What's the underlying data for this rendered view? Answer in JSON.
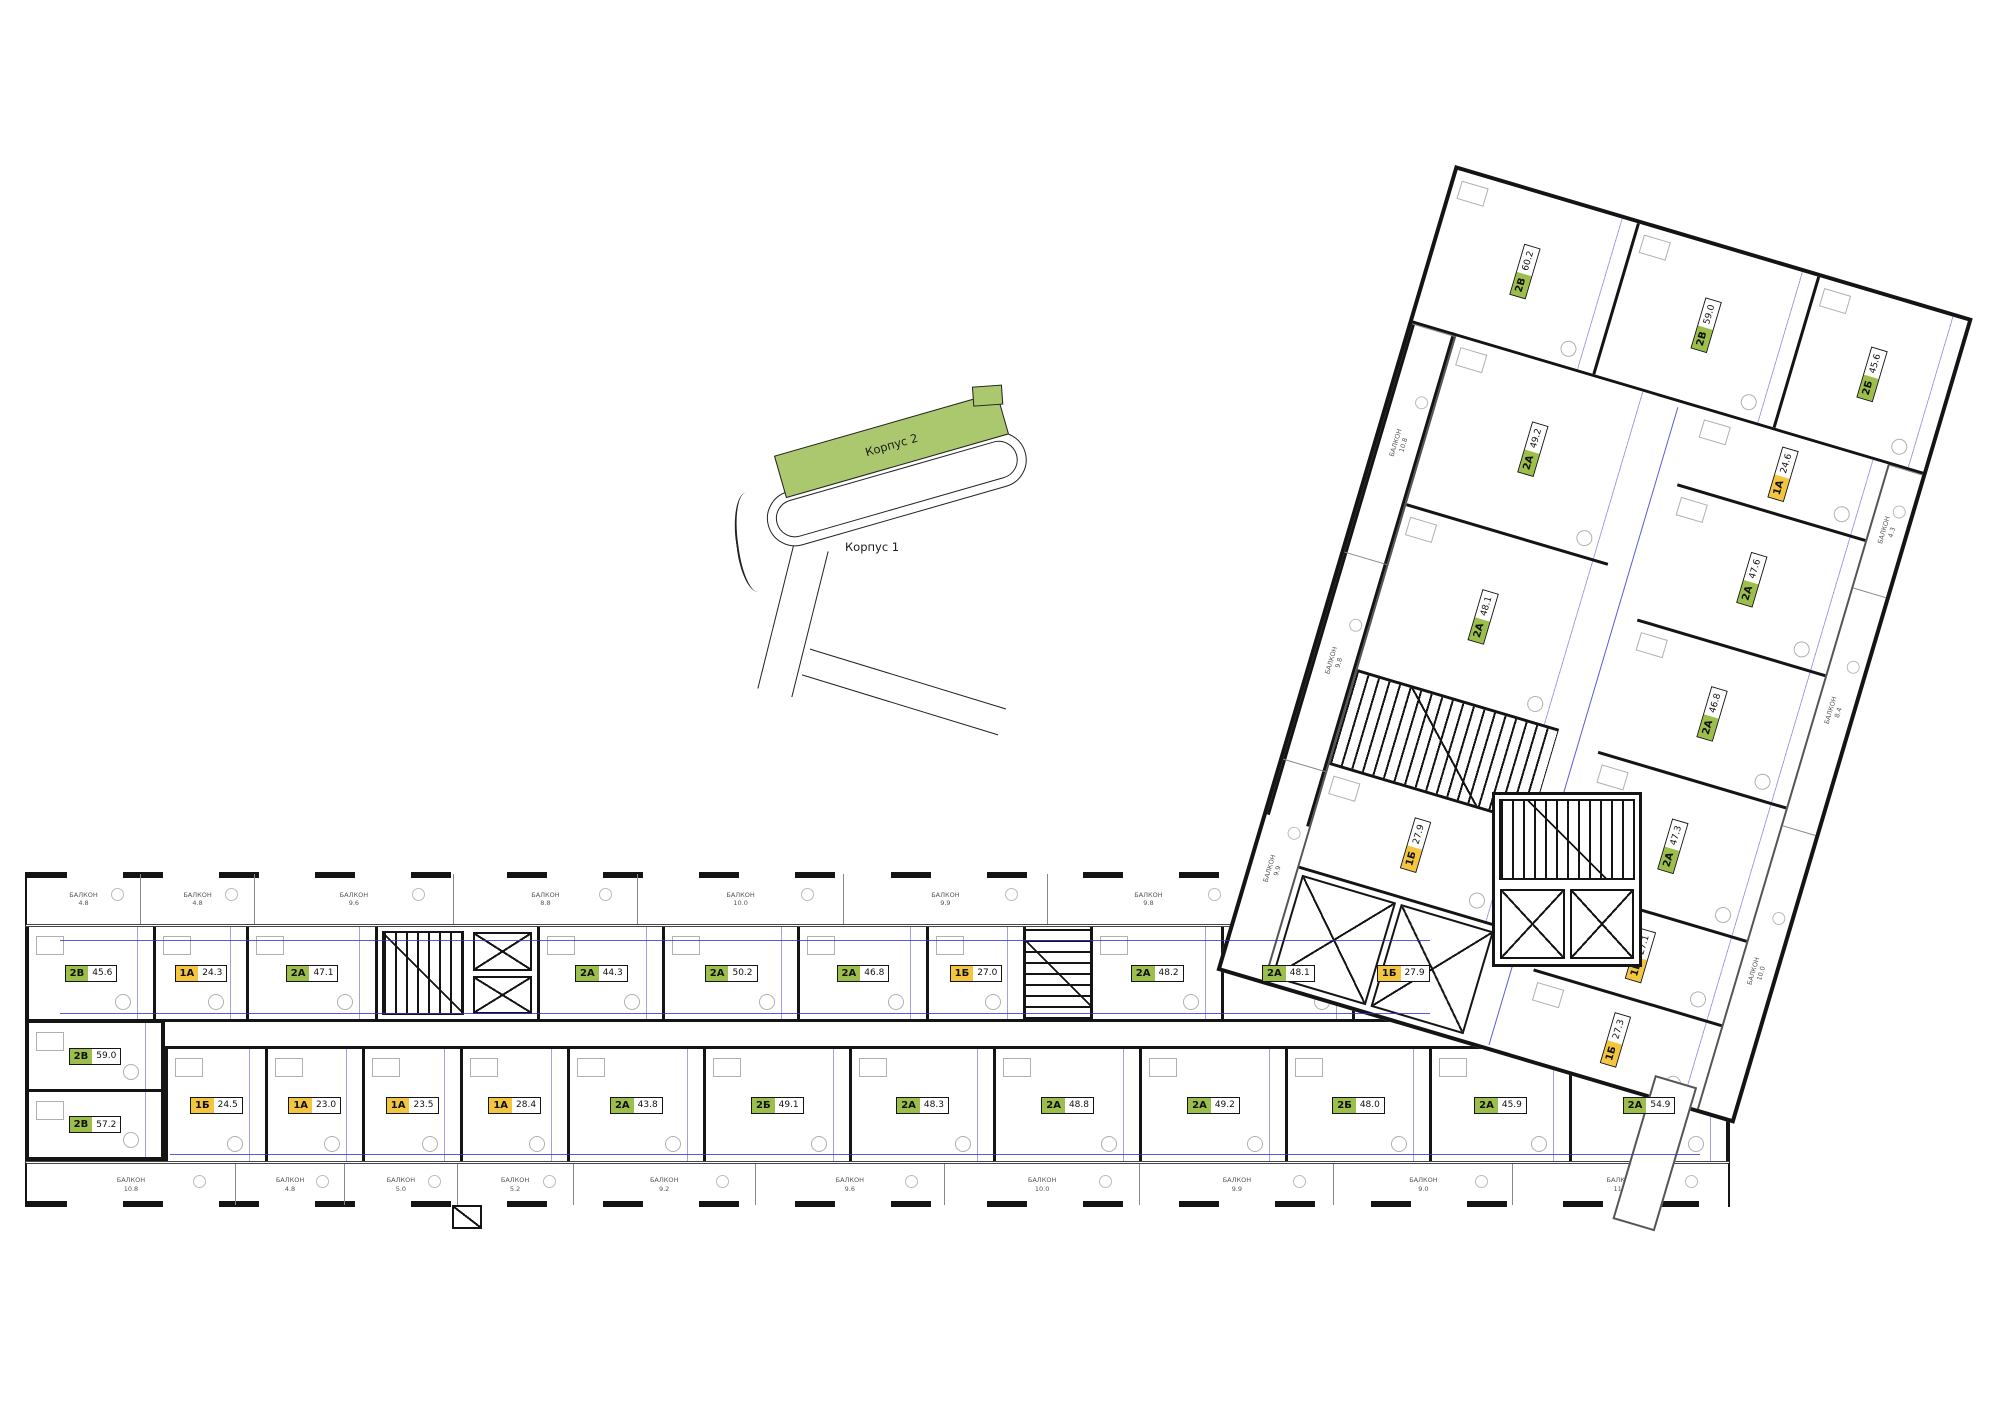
{
  "balcony_word": "БАЛКОН",
  "colors": {
    "unit_green": "#9CBE4A",
    "unit_yellow": "#F4C63F",
    "locator_green": "#ABC86F",
    "dimension_blue": "#3232CD",
    "wall_black": "#141414"
  },
  "locator": {
    "korpus2_label": "Корпус 2",
    "korpus1_label": "Корпус 1"
  },
  "bottom_wing": {
    "top_balconies": [
      "4.8",
      "4.8",
      "9.6",
      "8.8",
      "10.0",
      "9.9",
      "9.8",
      "9.9"
    ],
    "top_units_a": [
      {
        "t": "2В",
        "a": "45.6"
      },
      {
        "t": "1А",
        "a": "24.3"
      },
      {
        "t": "2А",
        "a": "47.1"
      }
    ],
    "top_units_b": [
      {
        "t": "2А",
        "a": "44.3"
      },
      {
        "t": "2А",
        "a": "50.2"
      },
      {
        "t": "2А",
        "a": "46.8"
      },
      {
        "t": "1Б",
        "a": "27.0"
      }
    ],
    "top_units_c": [
      {
        "t": "2А",
        "a": "48.2"
      },
      {
        "t": "2А",
        "a": "48.1"
      },
      {
        "t": "1Б",
        "a": "27.9"
      }
    ],
    "left_units": [
      {
        "t": "2В",
        "a": "59.0"
      },
      {
        "t": "2В",
        "a": "57.2"
      }
    ],
    "bottom_units": [
      {
        "t": "1Б",
        "a": "24.5"
      },
      {
        "t": "1А",
        "a": "23.0"
      },
      {
        "t": "1А",
        "a": "23.5"
      },
      {
        "t": "1А",
        "a": "28.4"
      },
      {
        "t": "2А",
        "a": "43.8"
      },
      {
        "t": "2Б",
        "a": "49.1"
      },
      {
        "t": "2А",
        "a": "48.3"
      },
      {
        "t": "2А",
        "a": "48.8"
      },
      {
        "t": "2А",
        "a": "49.2"
      },
      {
        "t": "2Б",
        "a": "48.0"
      },
      {
        "t": "2А",
        "a": "45.9"
      },
      {
        "t": "2А",
        "a": "54.9"
      }
    ],
    "bottom_balconies": [
      "10.8",
      "4.8",
      "5.0",
      "5.2",
      "9.2",
      "9.6",
      "10.0",
      "9.9",
      "9.0",
      "11.2"
    ]
  },
  "angled_wing": {
    "top_units": [
      {
        "t": "2В",
        "a": "60.2"
      },
      {
        "t": "2В",
        "a": "59.0"
      },
      {
        "t": "2Б",
        "a": "45.6"
      }
    ],
    "left_units_a": [
      {
        "t": "2А",
        "a": "49.2"
      },
      {
        "t": "2А",
        "a": "48.1"
      }
    ],
    "left_units_b": [
      {
        "t": "1Б",
        "a": "27.9"
      }
    ],
    "right_units": [
      {
        "t": "1А",
        "a": "24.6"
      },
      {
        "t": "2А",
        "a": "47.6"
      },
      {
        "t": "2А",
        "a": "46.8"
      },
      {
        "t": "2А",
        "a": "47.3"
      },
      {
        "t": "1Б",
        "a": "27.1"
      },
      {
        "t": "1Б",
        "a": "27.3"
      }
    ],
    "left_balconies": [
      "10.8",
      "9.8",
      "9.9"
    ],
    "right_balconies": [
      "4.3",
      "8.4",
      "10.0"
    ]
  }
}
